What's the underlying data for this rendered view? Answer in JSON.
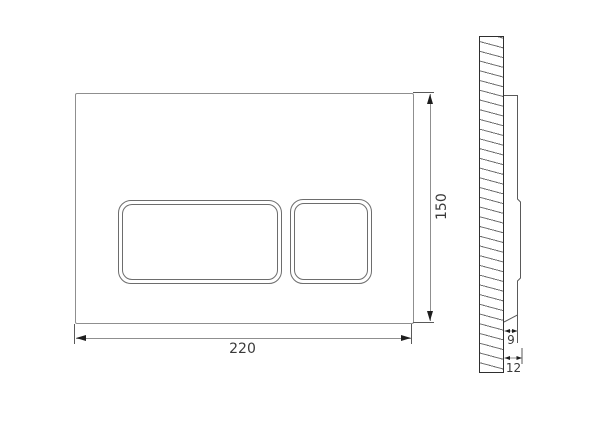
{
  "drawing": {
    "dimensions": {
      "plate_width": {
        "value": "220"
      },
      "plate_height": {
        "value": "150"
      },
      "plate_depth": {
        "value": "9"
      },
      "total_depth": {
        "value": "12"
      }
    },
    "colors": {
      "background": "#ffffff",
      "plate_outline": "#8f8f8f",
      "button_outline": "#6d6d6d",
      "dimension_line": "#8f8f8f",
      "extension_line": "#5a5a5a",
      "arrow": "#1e1e1e",
      "text": "#3a3a3a",
      "wall_outline": "#2f2f2f",
      "hatch": "#6f6f6f"
    }
  }
}
